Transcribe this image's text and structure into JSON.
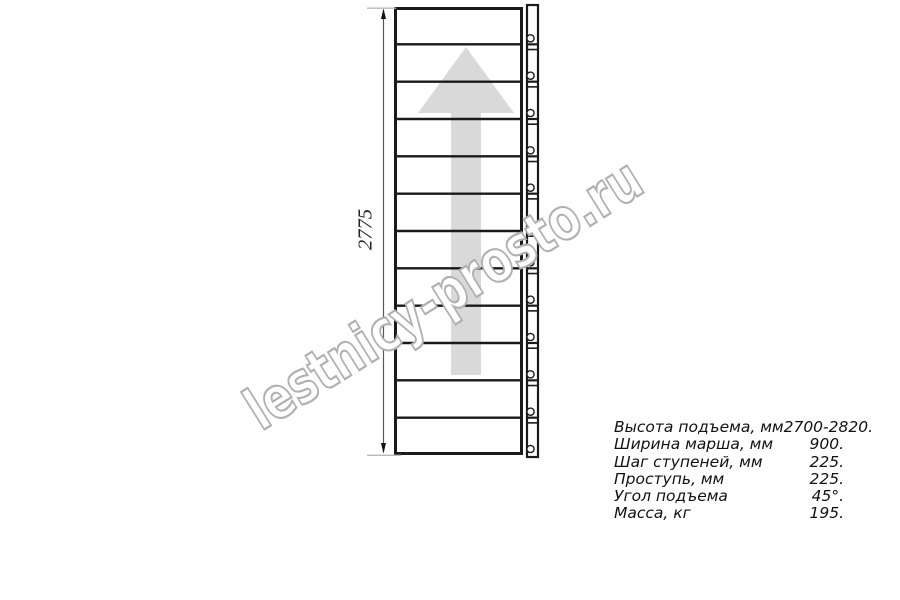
{
  "page": {
    "background_color": "#ffffff"
  },
  "watermark": {
    "text": "lestnicy-prosto.ru",
    "outline_color": "#b0b0b0"
  },
  "drawing": {
    "type": "straight-stair-flight-top-view",
    "steps_count": 12,
    "height_dimension_label": "2775",
    "line_color": "#1a1a1a",
    "arrow_color": "#d9d9d9",
    "dimension_line_color": "#555555",
    "extension_line_color": "#b9b9b9"
  },
  "specs": {
    "rows": [
      {
        "label": "Высота подъема, мм",
        "value": "2700-2820."
      },
      {
        "label": "Ширина марша, мм",
        "value": "900."
      },
      {
        "label": "Шаг ступеней, мм",
        "value": "225."
      },
      {
        "label": "Проступь, мм",
        "value": "225."
      },
      {
        "label": "Угол подъема",
        "value": "45°."
      },
      {
        "label": "Масса, кг",
        "value": "195."
      }
    ]
  }
}
